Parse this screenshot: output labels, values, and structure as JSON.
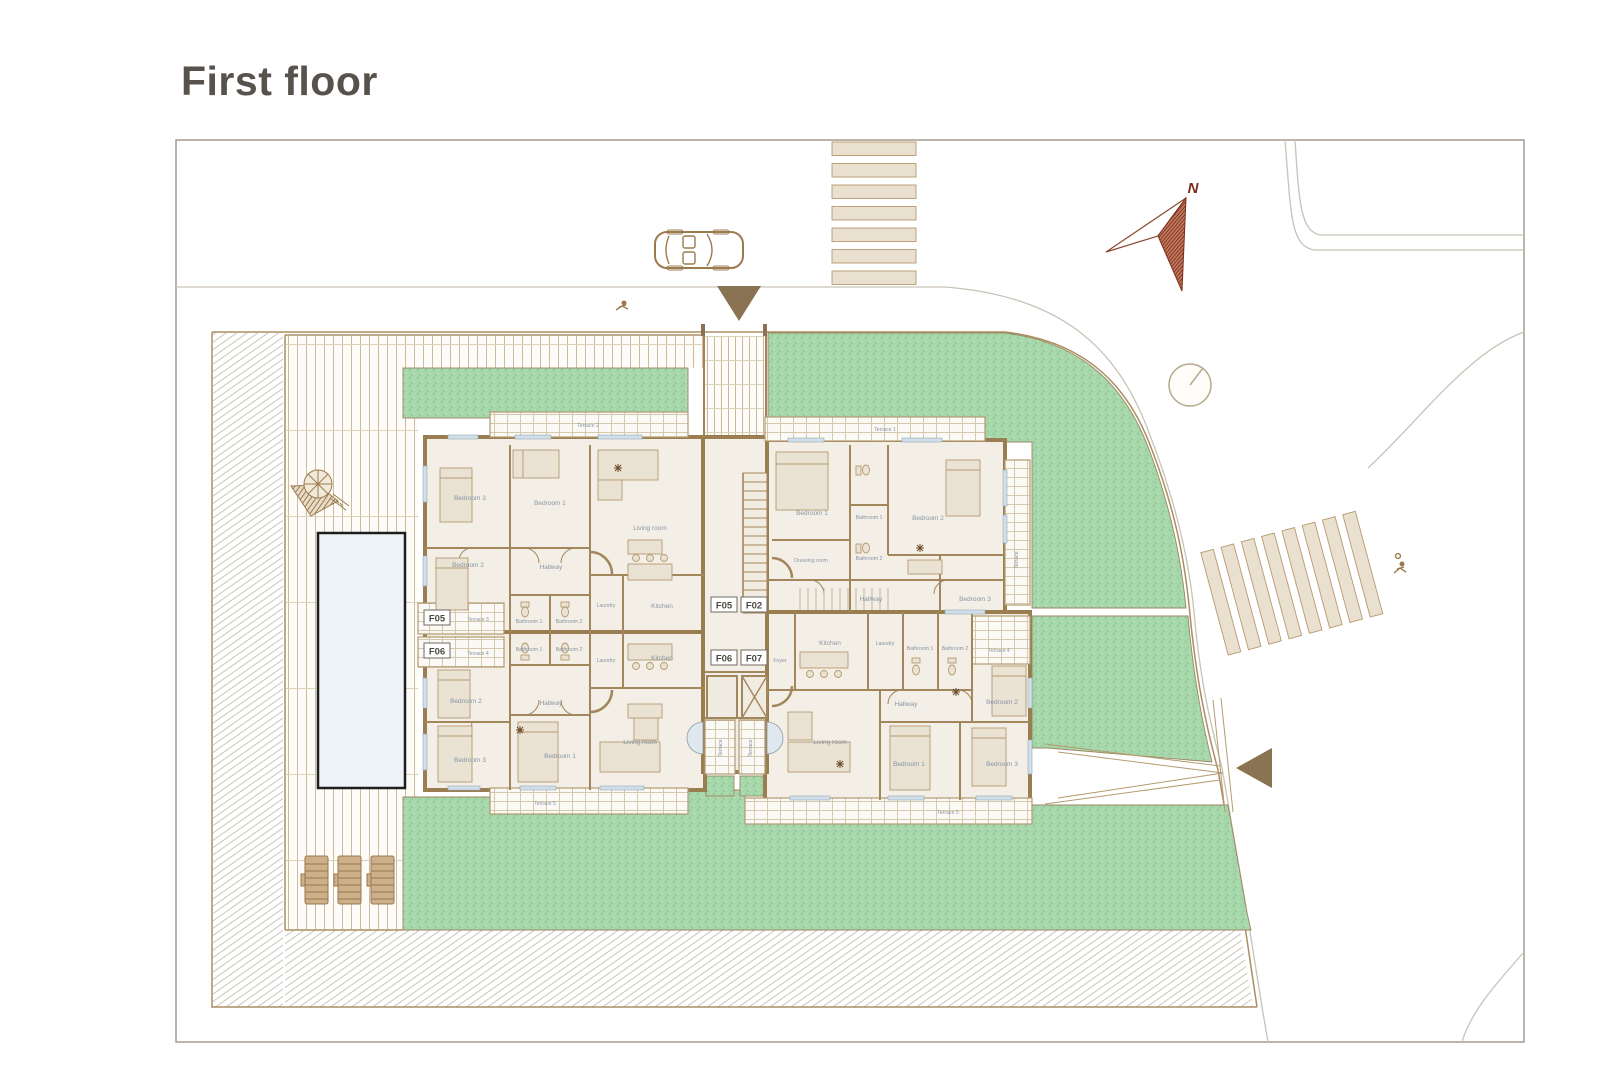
{
  "page": {
    "title": "First floor"
  },
  "compass": {
    "north_label": "N"
  },
  "badges": {
    "f05": "F05",
    "f02": "F02",
    "f06": "F06",
    "f07": "F07"
  },
  "apartments": {
    "f05": {
      "terrace_top": "Terrace 2",
      "bedroom3": "Bedroom 3",
      "bedroom1": "Bedroom 1",
      "living_room": "Living room",
      "bedroom2": "Bedroom 2",
      "hallway": "Hallway",
      "bathroom1": "Bathroom 1",
      "bathroom2": "Bathroom 2",
      "laundry": "Laundry",
      "kitchen": "Kitchen",
      "terrace_side": "Terrace 3"
    },
    "f02": {
      "terrace_top": "Terrace 1",
      "bedroom1": "Bedroom 1",
      "bathroom1": "Bathroom 1",
      "bathroom2": "Bathroom 2",
      "bedroom2": "Bedroom 2",
      "dressing_room": "Dressing room",
      "hallway": "Hallway",
      "bedroom3": "Bedroom 3",
      "terrace_side": "Terrace"
    },
    "f06": {
      "terrace_side": "Terrace 4",
      "bathroom1": "Bathroom 1",
      "bathroom2": "Bathroom 2",
      "laundry": "Laundry",
      "kitchen": "Kitchen",
      "bedroom2": "Bedroom 2",
      "hallway": "Hallway",
      "bedroom1": "Bedroom 1",
      "bedroom3": "Bedroom 3",
      "living_room": "Living room",
      "terrace_bottom": "Terrace 5",
      "terrace_center": "Terrace"
    },
    "f07": {
      "foyer": "Foyer",
      "kitchen": "Kitchen",
      "laundry": "Laundry",
      "bathroom1": "Bathroom 1",
      "bathroom2": "Bathroom 2",
      "terrace_side": "Terrace 4",
      "hallway": "Hallway",
      "bedroom2": "Bedroom 2",
      "living_room": "Living room",
      "bedroom1": "Bedroom 1",
      "bedroom3": "Bedroom 3",
      "terrace_bottom": "Terrace 5",
      "terrace_center": "Terrace"
    }
  }
}
